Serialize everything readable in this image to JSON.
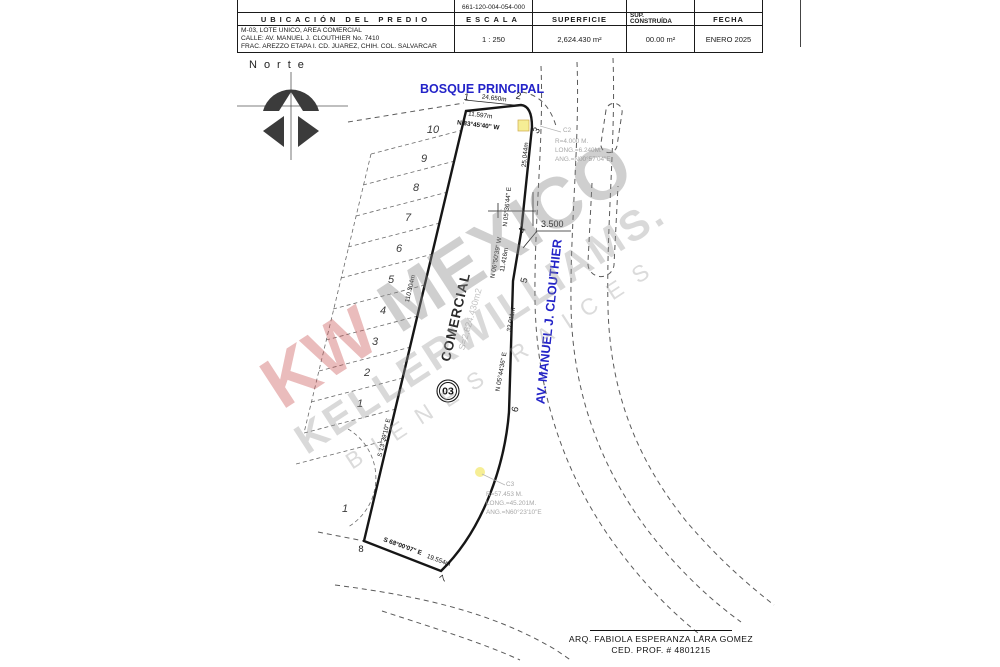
{
  "title_block": {
    "clave": "661-120-004-054-000",
    "ubicacion": {
      "header": "UBICACIÓN DEL PREDIO",
      "lines": [
        "M-03, LOTE UNICO, AREA COMERCIAL",
        "CALLE: AV. MANUEL J. CLOUTHIER No. 7410",
        "FRAC. AREZZO ETAPA I.  CD. JUAREZ, CHIH. COL. SALVARCAR"
      ]
    },
    "escala": {
      "header": "ESCALA",
      "value": "1 : 250"
    },
    "superficie": {
      "header": "SUPERFICIE",
      "value": "2,624.430 m²"
    },
    "sup_construida": {
      "header1": "SUP.",
      "header2": "CONSTRUÍDA",
      "value": "00.00 m²"
    },
    "fecha": {
      "header": "FECHA",
      "value": "ENERO 2025"
    }
  },
  "north": {
    "label": "Norte"
  },
  "plan": {
    "street_top": "BOSQUE PRINCIPAL",
    "street_right": "AV. MANUEL J. CLOUTHIER",
    "lot_use": "COMERCIAL",
    "lot_area_note": "S=2,624.430m2",
    "lot_number": "03",
    "elevation_label": "3.500",
    "block_number": "1",
    "vertices": [
      "1",
      "2",
      "3",
      "4",
      "5",
      "6",
      "7",
      "8"
    ],
    "stall_numbers": [
      "10",
      "9",
      "8",
      "7",
      "6",
      "5",
      "4",
      "3",
      "2",
      "1"
    ],
    "dimensions": {
      "top_len": "24.650m",
      "top_len2": "11.597m",
      "top_bearing": "N 83°45'40\" W",
      "right1_len": "25.044m",
      "right1_bearing": "N 05°36'44\" E",
      "right2_bearing": "N 06°50'39\" W",
      "right2_len": "11.416m",
      "right3_len": "32.011m",
      "right3_bearing": "N 05°44'36\" E",
      "left_len": "110.304m",
      "left_bearing": "S 13°39'10\" E",
      "bottom_bearing": "S 68°00'07\" E",
      "bottom_len": "19.554m"
    },
    "curve2": {
      "name": "C2",
      "lines": [
        "R=4.000  M.",
        "LONG.=6.240M.",
        "ANG.=N00°57'04\"E"
      ]
    },
    "curve3": {
      "name": "C3",
      "lines": [
        "R=57.453  M.",
        "LONG.=45.201M.",
        "ANG.=N60°23'10\"E"
      ]
    }
  },
  "watermark": {
    "kw": "KW",
    "mexico": "MEXICO",
    "keller": "KELLERWILLIAMS.",
    "bienes": "BIENES RAICES"
  },
  "signature": {
    "line1": "ARQ. FABIOLA ESPERANZA LARA GOMEZ",
    "line2": "CED. PROF. # 4801215"
  },
  "colors": {
    "street_blue": "#2323c8",
    "kw_red": "#ca5858",
    "watermark_gray": "#969696",
    "highlight_yellow": "#f5ec8a"
  }
}
